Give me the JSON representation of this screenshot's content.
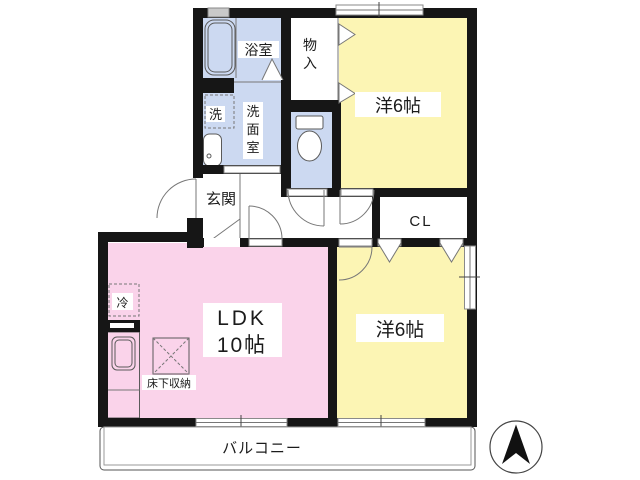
{
  "title": "2LDK apartment floor plan",
  "colors": {
    "wall": "#161616",
    "room_blue": "#ccd9f1",
    "room_yellow": "#fcf5b4",
    "room_pink": "#fad3ea",
    "line": "#777777"
  },
  "rooms": {
    "bathroom": {
      "label": "浴室"
    },
    "storage": {
      "label": "物入",
      "chars": [
        "物",
        "入"
      ]
    },
    "washer": {
      "label": "洗"
    },
    "washroom": {
      "label": "洗面室",
      "chars": [
        "洗",
        "面",
        "室"
      ]
    },
    "entrance": {
      "label": "玄関"
    },
    "closet": {
      "label": "CL"
    },
    "bedroom_top": {
      "label": "洋6帖"
    },
    "bedroom_bottom": {
      "label": "洋6帖"
    },
    "ldk": {
      "label_line1": "LDK",
      "label_line2": "10帖"
    },
    "refrigerator": {
      "label": "冷"
    },
    "floor_storage": {
      "label": "床下収納"
    },
    "balcony": {
      "label": "バルコニー"
    }
  },
  "icons": {
    "bathtub": "bathtub-icon",
    "toilet": "toilet-icon",
    "washbasin": "washbasin-icon",
    "kitchen_sink": "kitchen-sink-icon",
    "north_arrow": "north-arrow-icon"
  }
}
